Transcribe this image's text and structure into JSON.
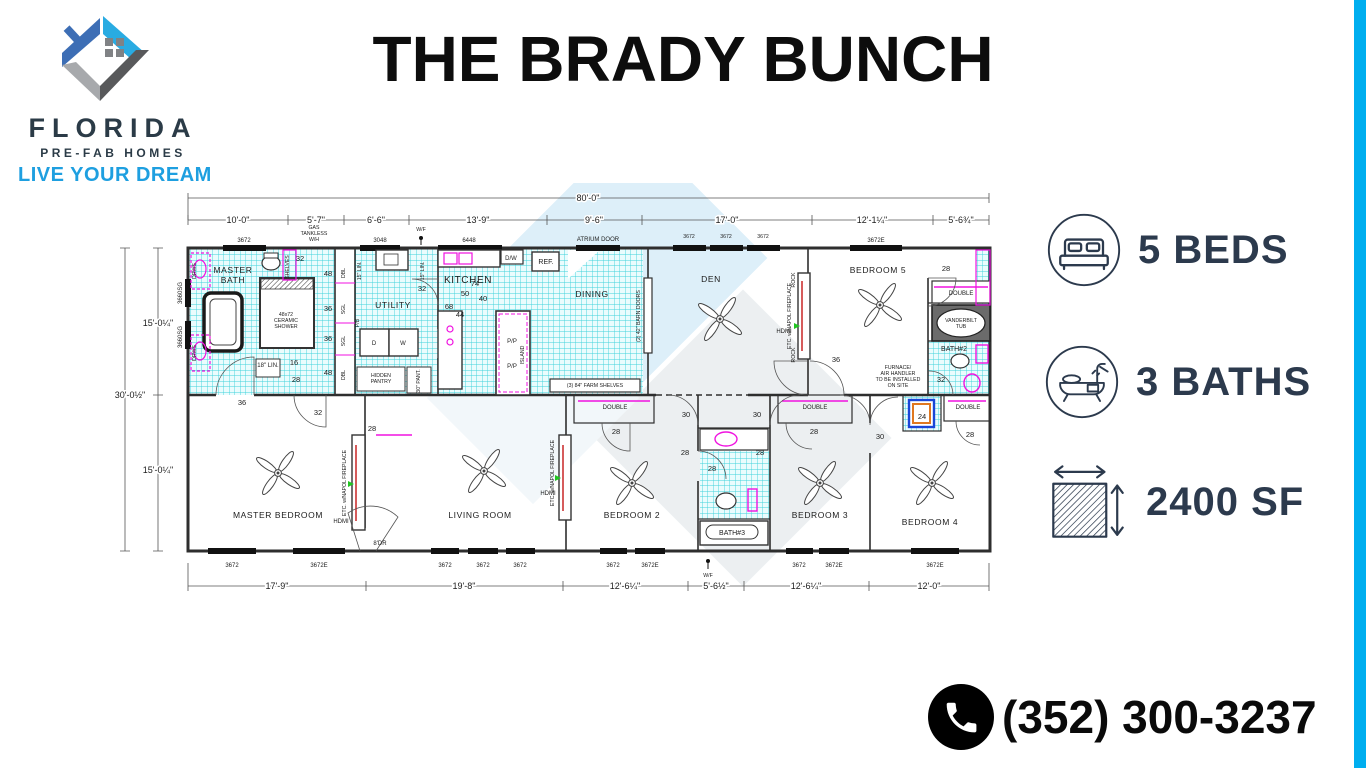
{
  "brand": {
    "logo_icon": "house-logo-icon",
    "name": "FLORIDA",
    "sub": "PRE-FAB HOMES",
    "tagline": "LIVE YOUR DREAM"
  },
  "title": "THE BRADY BUNCH",
  "stats": {
    "beds": {
      "icon": "bed-icon",
      "label": "5 BEDS"
    },
    "baths": {
      "icon": "bathtub-icon",
      "label": "3 BATHS"
    },
    "area": {
      "icon": "area-hatch-icon",
      "label": "2400 SF"
    }
  },
  "phone": {
    "icon": "phone-icon",
    "number": "(352) 300-3237"
  },
  "colors": {
    "accent_bar": "#00AEEF",
    "tile_grid": "#3ED2DB",
    "fixture_magenta": "#F012E0",
    "stat_text": "#2C3A4D"
  },
  "fp": {
    "dims": {
      "overall": "80'-0\"",
      "top": [
        "10'-0\"",
        "5'-7\"",
        "6'-6\"",
        "13'-9\"",
        "9'-6\"",
        "17'-0\"",
        "12'-1¼\"",
        "5'-6¾\""
      ],
      "bottom": [
        "17'-9\"",
        "19'-8\"",
        "12'-6¼\"",
        "5'-6½\"",
        "12'-6¼\"",
        "12'-0\""
      ],
      "left_half": "15'-0¼\"",
      "left_overall": "30'-0½\""
    },
    "rooms": {
      "master_bath1": "MASTER",
      "master_bath2": "BATH",
      "utility": "UTILITY",
      "kitchen": "KITCHEN",
      "dining": "DINING",
      "den": "DEN",
      "bedroom5": "BEDROOM 5",
      "bath2": "BATH#2",
      "master_bedroom": "MASTER BEDROOM",
      "living": "LIVING ROOM",
      "bedroom2": "BEDROOM 2",
      "bath3": "BATH#3",
      "bedroom3": "BEDROOM 3",
      "bedroom4": "BEDROOM 4"
    },
    "win": {
      "a": "3672",
      "e": "3672E",
      "k": "3048",
      "big": "6448",
      "fixed": "FIXED",
      "sg": "3660SG"
    },
    "num": {
      "n16": "16",
      "n24": "24",
      "n28": "28",
      "n30": "30",
      "n32": "32",
      "n36": "36",
      "n40": "40",
      "n44": "44",
      "n48": "48",
      "n50": "50",
      "n68": "68",
      "n74": "74"
    },
    "feat": {
      "shelves": "SHELVES",
      "drws": "DRWS",
      "gas1": "GAS",
      "gas2": "TANKLESS",
      "gas3": "W/H",
      "wf": "W/F",
      "atrium": "ATRIUM DOOR",
      "barn": "(2) 42\" BARN DOORS",
      "farm": "(3) 84\" FARM SHELVES",
      "hidden1": "HIDDEN",
      "hidden2": "PANTRY",
      "pant30": "30\" PANT.",
      "lin18": "18\" LIN.",
      "lin15": "15\" LIN.",
      "island": "ISLAND",
      "pp": "P/P",
      "dw": "D/W",
      "ref": "REF.",
      "pb": "P/B",
      "w": "W",
      "d": "D",
      "rock": "ROCK",
      "fire": "ETC. w/NAPOL FIREPLACE",
      "hdmi": "HDMI",
      "double": "DOUBLE",
      "dbl": "DBL",
      "sgl": "SGL",
      "vtub1": "VANDERBILT",
      "vtub2": "TUB",
      "furn1": "FURNACE/",
      "furn2": "AIR HANDLER",
      "furn3": "TO BE INSTALLED",
      "furn4": "ON SITE",
      "dr8": "8'DR",
      "shower1": "48x72",
      "shower2": "CERAMIC",
      "shower3": "SHOWER"
    }
  }
}
